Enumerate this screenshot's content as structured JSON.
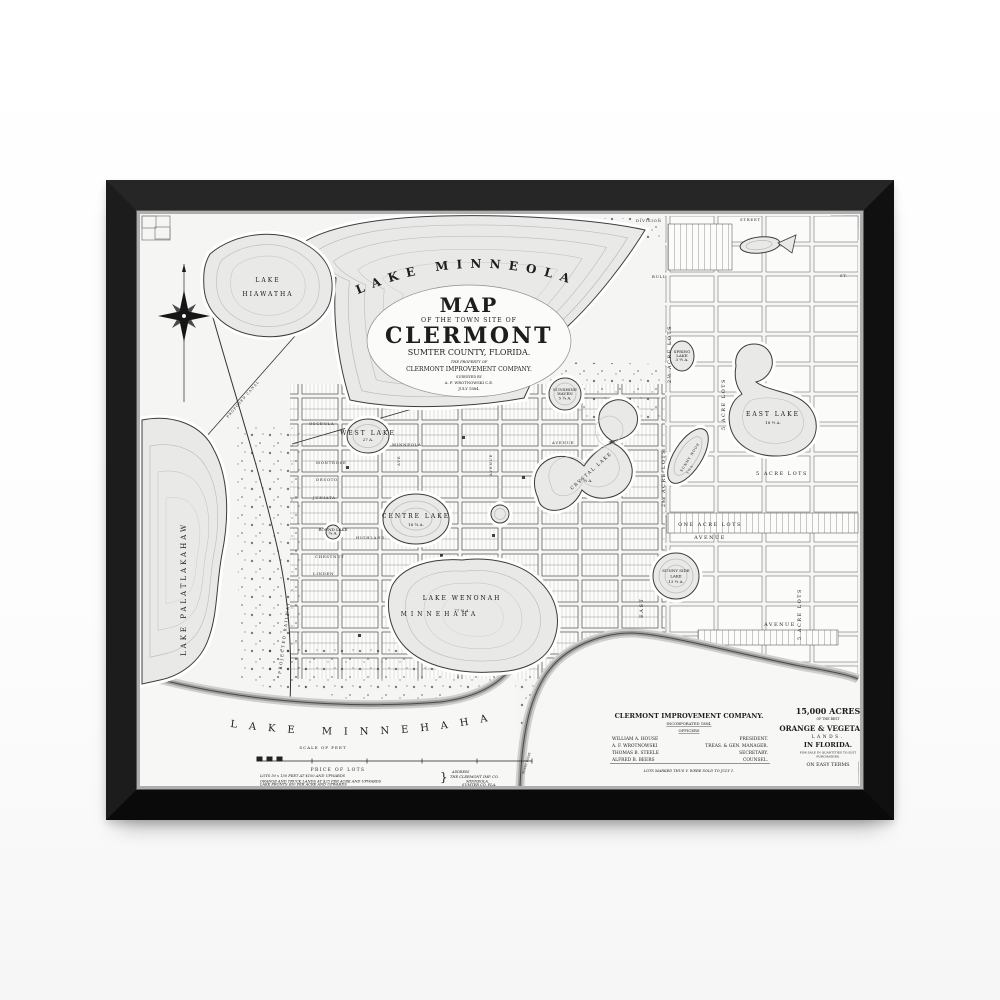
{
  "map": {
    "title": {
      "lake_top": "LAKE MINNEOLA",
      "map_word": "MAP",
      "of_line": "OF THE TOWN SITE OF",
      "town": "CLERMONT",
      "county": "SUMTER COUNTY, FLORIDA.",
      "property_of": "THE PROPERTY OF",
      "company": "CLERMONT IMPROVEMENT COMPANY.",
      "surveyed_by": "SURVEYED BY",
      "surveyor": "A. F. WROTNOWSKI C.E.",
      "date": "JULY 1884."
    },
    "lakes": {
      "minneola": "LAKE MINNEOLA",
      "hiawatha_1": "LAKE",
      "hiawatha_2": "HIAWATHA",
      "palatlakaha": "LAKE PALATLAKAHAW",
      "minnehaha": "LAKE MINNEHAHA",
      "wenonah": {
        "name": "LAKE WENONAH",
        "acres": "77 ½ A."
      },
      "centre": {
        "name": "CENTRE LAKE",
        "acres": "16 ¾ A."
      },
      "crystal": {
        "name": "CRYSTAL LAKE",
        "acres": "7 ½ A."
      },
      "west": {
        "name": "WEST LAKE",
        "acres": "27 A."
      },
      "sunshine": {
        "l1": "SUNSHINE",
        "l2": "HAVEN",
        "acres": "5 ¾ A."
      },
      "spring": {
        "l1": "SPRING",
        "l2": "LAKE",
        "acres": "3 ½ A."
      },
      "east_lake": {
        "name": "EAST LAKE",
        "acres": "18 ½ A."
      },
      "sunny_nook": {
        "name": "SUNNY NOOK",
        "acres": "9 ½ A."
      },
      "sunny_side": {
        "l1": "SUNNY SIDE",
        "l2": "LAKE",
        "acres": "13 ½ A."
      },
      "round": {
        "name": "ROUND LAKE",
        "acres": "¾ A."
      }
    },
    "streets": {
      "division": "DIVISION",
      "street": "STREET",
      "bull": "BULL",
      "st": "ST.",
      "osceola": "OSCEOLA",
      "montrose": "MONTROSE",
      "desoto": "DESOTO",
      "juniata": "JUNIATA",
      "highland": "HIGHLAND",
      "chestnut": "CHESTNUT",
      "linden": "LINDEN",
      "minneola": "MINNEOLA",
      "ave": "AVE",
      "avenue": "AVENUE",
      "minnehaha": "MINNEHAHA",
      "east": "EAST"
    },
    "districts": {
      "two_half_acre": "2½ ACRE LOTS",
      "five_acre": "5 ACRE LOTS",
      "one_acre": "ONE ACRE LOTS"
    },
    "features": {
      "projected_railway": "PROJECTED RAILWAY",
      "proposed_canal": "PROPOSED CANAL",
      "rocky_point": "ROCKY POINT"
    },
    "legend": {
      "scale_title": "SCALE OF FEET",
      "price_title": "PRICE OF LOTS",
      "price_1": "LOTS 50 x 150 FEET AT $100 AND UPWARDS",
      "price_2": "ORANGE AND TRUCK LANDS AT $25 PER ACRE AND UPWARDS",
      "price_3": "LAKE FRONTS $50 PER ACRE AND UPWARDS",
      "address_label": "ADDRESS",
      "address_1": "THE CLERMONT IMP. CO.",
      "address_2": "MINNEOLA.",
      "address_3": "SUMTER CO. FLA."
    },
    "company_block": {
      "name": "CLERMONT IMPROVEMENT COMPANY.",
      "incorporated": "INCORPORATED 1884.",
      "officers_label": "OFFICERS",
      "officers": [
        {
          "name": "WILLIAM A. HOUSE",
          "title": "PRESIDENT."
        },
        {
          "name": "A. F. WROTNOWSKI",
          "title": "TREAS. & GEN. MANAGER."
        },
        {
          "name": "THOMAS B. STEELE",
          "title": "SECRETARY."
        },
        {
          "name": "ALFRED B. BEERS",
          "title": "COUNSEL."
        }
      ],
      "note": "LOTS MARKED THUS V. WERE SOLD TO JULY 1."
    },
    "ad_block": {
      "acres": "15,000 ACRES",
      "of_best": "OF THE BEST",
      "orange_veg": "ORANGE & VEGETABLE",
      "lands": "LANDS.",
      "in_florida": "IN FLORIDA.",
      "for_sale_1": "FOR SALE IN QUANTITIES TO SUIT",
      "for_sale_2": "PURCHASERS.",
      "easy_terms": "ON EASY TERMS"
    }
  }
}
